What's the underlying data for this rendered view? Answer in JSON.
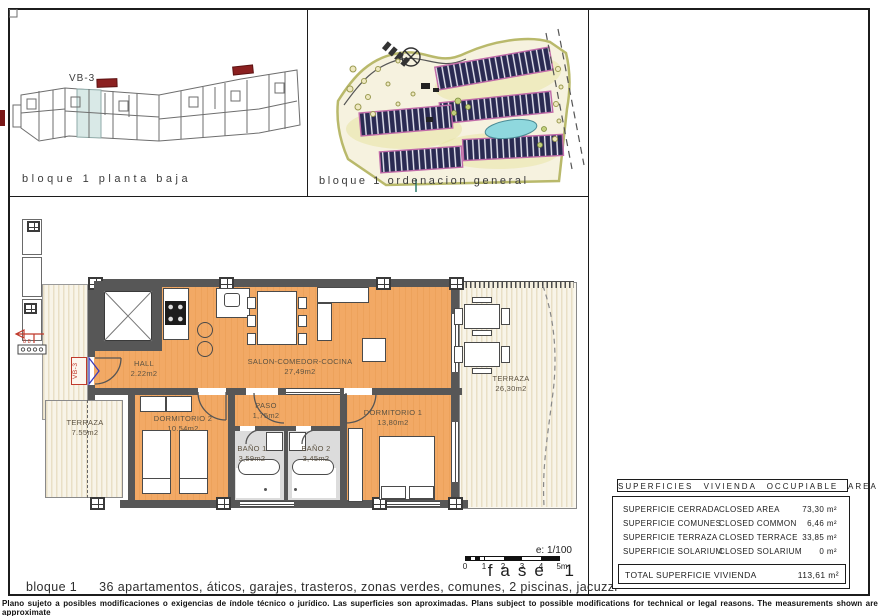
{
  "page": {
    "panel_tl_label": "bloque 1 planta baja",
    "panel_tr_label": "bloque 1 ordenacion general",
    "unit_tag": "VB-3",
    "scale_label": "e: 1/100",
    "scale_ticks": [
      "0",
      "1",
      "2",
      "3",
      "4",
      "5m"
    ],
    "phase_label": "fase 1",
    "caption_block": "bloque 1",
    "caption_features": "36 apartamentos, áticos, garajes, trasteros, zonas verdes, comunes, 2 piscinas, jacuzzi",
    "disclaimer": "Plano sujeto a posibles modificaciones o exigencias de índole técnico o jurídico. Las superficies son aproximadas. Plans subject to possible modifications for technical or legal reasons. The measurements shown are approximate"
  },
  "plan": {
    "rooms": [
      {
        "name": "HALL",
        "area": "2.22m2"
      },
      {
        "name": "SALON-COMEDOR-COCINA",
        "area": "27,49m2"
      },
      {
        "name": "TERRAZA",
        "area": "7.55m2"
      },
      {
        "name": "DORMITORIO 2",
        "area": "10.54m2"
      },
      {
        "name": "PASO",
        "area": "1,75m2"
      },
      {
        "name": "BAÑO 1",
        "area": "3,59m2"
      },
      {
        "name": "BAÑO 2",
        "area": "3,45m2"
      },
      {
        "name": "DORMITORIO 1",
        "area": "13,80m2"
      },
      {
        "name": "TERRAZA",
        "area": "26,30m2"
      }
    ]
  },
  "areas_table": {
    "title": "SUPERFICIES VIVIENDA OCCUPIABLE AREA",
    "rows": [
      {
        "es": "SUPERFICIE CERRADA",
        "en": "CLOSED AREA",
        "value": "73,30 m²"
      },
      {
        "es": "SUPERFICIE COMUNES",
        "en": "CLOSED COMMON",
        "value": "6,46 m²"
      },
      {
        "es": "SUPERFICIE TERRAZA",
        "en": "CLOSED TERRACE",
        "value": "33,85 m²"
      },
      {
        "es": "SUPERFICIE SOLARIUM",
        "en": "CLOSED SOLARIUM",
        "value": "0 m²"
      }
    ],
    "total_label": "TOTAL SUPERFICIE VIVIENDA",
    "total_value": "113,61 m²"
  },
  "colors": {
    "floor_orange": "#f0a761",
    "deck_cream": "#f5f0e2",
    "wall_gray": "#575757",
    "accent_red": "#c0392b",
    "accent_blue": "#3a3ab8",
    "site_building": "#2a2a52",
    "site_pink": "#c06aa8",
    "site_olive": "#b9b96b",
    "pool_cyan": "#8fd8de"
  }
}
